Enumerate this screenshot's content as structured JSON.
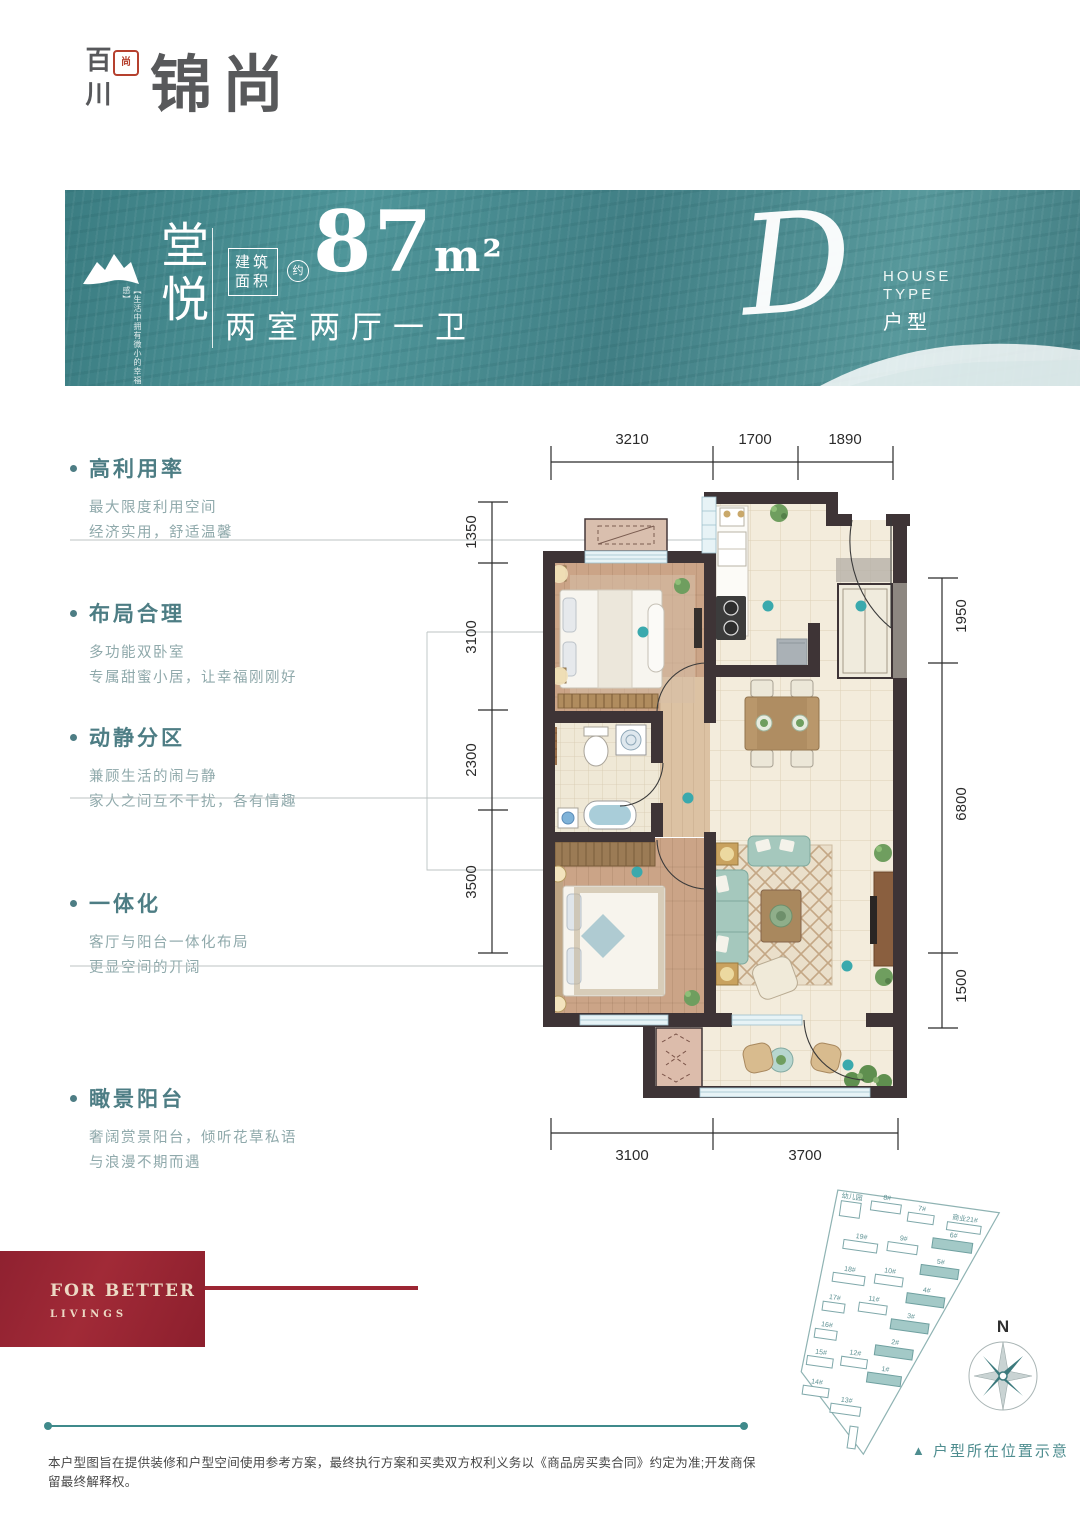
{
  "logo": {
    "vertical": "百川",
    "seal": "尚",
    "main": "锦尚"
  },
  "banner": {
    "name": "堂悦",
    "slogan": "【生活中拥有微小的幸福感】",
    "area_label_top": "建筑",
    "area_label_bottom": "面积",
    "approx": "约",
    "area_value": "87",
    "area_unit": "m²",
    "rooms": "两室两厅一卫",
    "type_letter": "D",
    "type_en_line1": "HOUSE",
    "type_en_line2": "TYPE",
    "type_cn": "户型"
  },
  "features": [
    {
      "title": "高利用率",
      "line1": "最大限度利用空间",
      "line2": "经济实用，舒适温馨"
    },
    {
      "title": "布局合理",
      "line1": "多功能双卧室",
      "line2": "专属甜蜜小居，让幸福刚刚好"
    },
    {
      "title": "动静分区",
      "line1": "兼顾生活的闹与静",
      "line2": "家人之间互不干扰，各有情趣"
    },
    {
      "title": "一体化",
      "line1": "客厅与阳台一体化布局",
      "line2": "更显空间的开阔"
    },
    {
      "title": "瞰景阳台",
      "line1": "奢阔赏景阳台，倾听花草私语",
      "line2": "与浪漫不期而遇"
    }
  ],
  "plan": {
    "dims_top": [
      "3210",
      "1700",
      "1890"
    ],
    "dims_left": [
      "1350",
      "3100",
      "2300",
      "3500"
    ],
    "dims_right": [
      "1950",
      "6800",
      "1500"
    ],
    "dims_bottom": [
      "3100",
      "3700"
    ]
  },
  "siteplan": {
    "compass": "N",
    "caption_marker": "▲",
    "caption": "户型所在位置示意",
    "buildings": [
      {
        "label": "幼儿园",
        "highlight": false
      },
      {
        "label": "8#",
        "highlight": false
      },
      {
        "label": "7#",
        "highlight": false
      },
      {
        "label": "商业21#",
        "highlight": false
      },
      {
        "label": "6#",
        "highlight": true
      },
      {
        "label": "19#",
        "highlight": false
      },
      {
        "label": "9#",
        "highlight": false
      },
      {
        "label": "5#",
        "highlight": true
      },
      {
        "label": "18#",
        "highlight": false
      },
      {
        "label": "10#",
        "highlight": false
      },
      {
        "label": "4#",
        "highlight": true
      },
      {
        "label": "17#",
        "highlight": false
      },
      {
        "label": "11#",
        "highlight": false
      },
      {
        "label": "3#",
        "highlight": true
      },
      {
        "label": "16#",
        "highlight": false
      },
      {
        "label": "2#",
        "highlight": true
      },
      {
        "label": "15#",
        "highlight": false
      },
      {
        "label": "12#",
        "highlight": false
      },
      {
        "label": "1#",
        "highlight": true
      },
      {
        "label": "14#",
        "highlight": false
      },
      {
        "label": "13#",
        "highlight": false
      }
    ]
  },
  "footer": {
    "tagline_line1": "FOR BETTER",
    "tagline_line2": "LIVINGS",
    "disclaimer": "本户型图旨在提供装修和户型空间使用参考方案，最终执行方案和买卖双方权利义务以《商品房买卖合同》约定为准;开发商保留最终解释权。"
  },
  "colors": {
    "teal_banner": "#47898c",
    "teal_text": "#4d7d84",
    "accent_dot": "#3aa9ad",
    "red": "#9c2633",
    "wall": "#3e3436",
    "wood": "#cba487",
    "cream_floor": "#f3ecdc"
  }
}
